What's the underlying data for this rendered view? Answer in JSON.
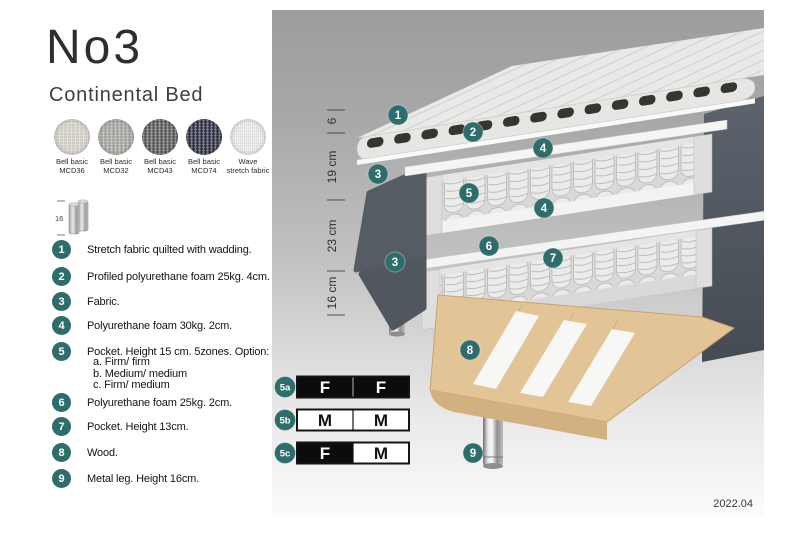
{
  "header": {
    "title": "No3",
    "subtitle": "Continental Bed"
  },
  "swatches": [
    {
      "name": "Bell basic",
      "code": "MCD36",
      "color": "#d9d5cc"
    },
    {
      "name": "Bell basic",
      "code": "MCD32",
      "color": "#a9a8a4"
    },
    {
      "name": "Bell basic",
      "code": "MCD43",
      "color": "#5c5c5a"
    },
    {
      "name": "Bell basic",
      "code": "MCD74",
      "color": "#2e3147"
    },
    {
      "name": "Wave",
      "code": "stretch fabric",
      "color": "#eceef0"
    }
  ],
  "leg_icon": {
    "height_label": "16"
  },
  "legend": [
    {
      "num": "1",
      "text": "Stretch fabric quilted with wadding."
    },
    {
      "num": "2",
      "text": "Profiled polyurethane foam 25kg. 4cm."
    },
    {
      "num": "3",
      "text": "Fabric."
    },
    {
      "num": "4",
      "text": "Polyurethane foam 30kg. 2cm."
    },
    {
      "num": "5",
      "text": "Pocket. Height 15 cm. 5zones. Option:",
      "options": [
        "a. Firm/ firm",
        "b. Medium/ medium",
        "c. Firm/ medium"
      ]
    },
    {
      "num": "6",
      "text": "Polyurethane foam 25kg. 2cm."
    },
    {
      "num": "7",
      "text": "Pocket. Height 13cm."
    },
    {
      "num": "8",
      "text": "Wood."
    },
    {
      "num": "9",
      "text": "Metal leg. Height 16cm."
    }
  ],
  "diagram": {
    "ruler_segments": [
      {
        "label": "6",
        "y": 111
      },
      {
        "label": "19 cm",
        "y": 157
      },
      {
        "label": "23 cm",
        "y": 226
      },
      {
        "label": "16 cm",
        "y": 283
      }
    ],
    "callouts": [
      {
        "label": "1",
        "x": 126,
        "y": 105
      },
      {
        "label": "2",
        "x": 201,
        "y": 122
      },
      {
        "label": "4",
        "x": 271,
        "y": 138
      },
      {
        "label": "3",
        "x": 106,
        "y": 164
      },
      {
        "label": "5",
        "x": 197,
        "y": 183
      },
      {
        "label": "4",
        "x": 272,
        "y": 198
      },
      {
        "label": "6",
        "x": 217,
        "y": 236
      },
      {
        "label": "7",
        "x": 281,
        "y": 248
      },
      {
        "label": "3",
        "x": 123,
        "y": 252
      },
      {
        "label": "8",
        "x": 198,
        "y": 340
      },
      {
        "label": "9",
        "x": 201,
        "y": 443
      }
    ],
    "firmness_table": [
      {
        "label": "5a",
        "cells": [
          {
            "text": "F",
            "variant": "dark"
          },
          {
            "text": "F",
            "variant": "dark"
          }
        ]
      },
      {
        "label": "5b",
        "cells": [
          {
            "text": "M",
            "variant": "light"
          },
          {
            "text": "M",
            "variant": "light"
          }
        ]
      },
      {
        "label": "5c",
        "cells": [
          {
            "text": "F",
            "variant": "dark"
          },
          {
            "text": "M",
            "variant": "light"
          }
        ]
      }
    ],
    "date": "2022.04",
    "colors": {
      "teal": "#2e6d6b",
      "dark_fabric": "#565c64",
      "wood": "#e2c497"
    }
  }
}
